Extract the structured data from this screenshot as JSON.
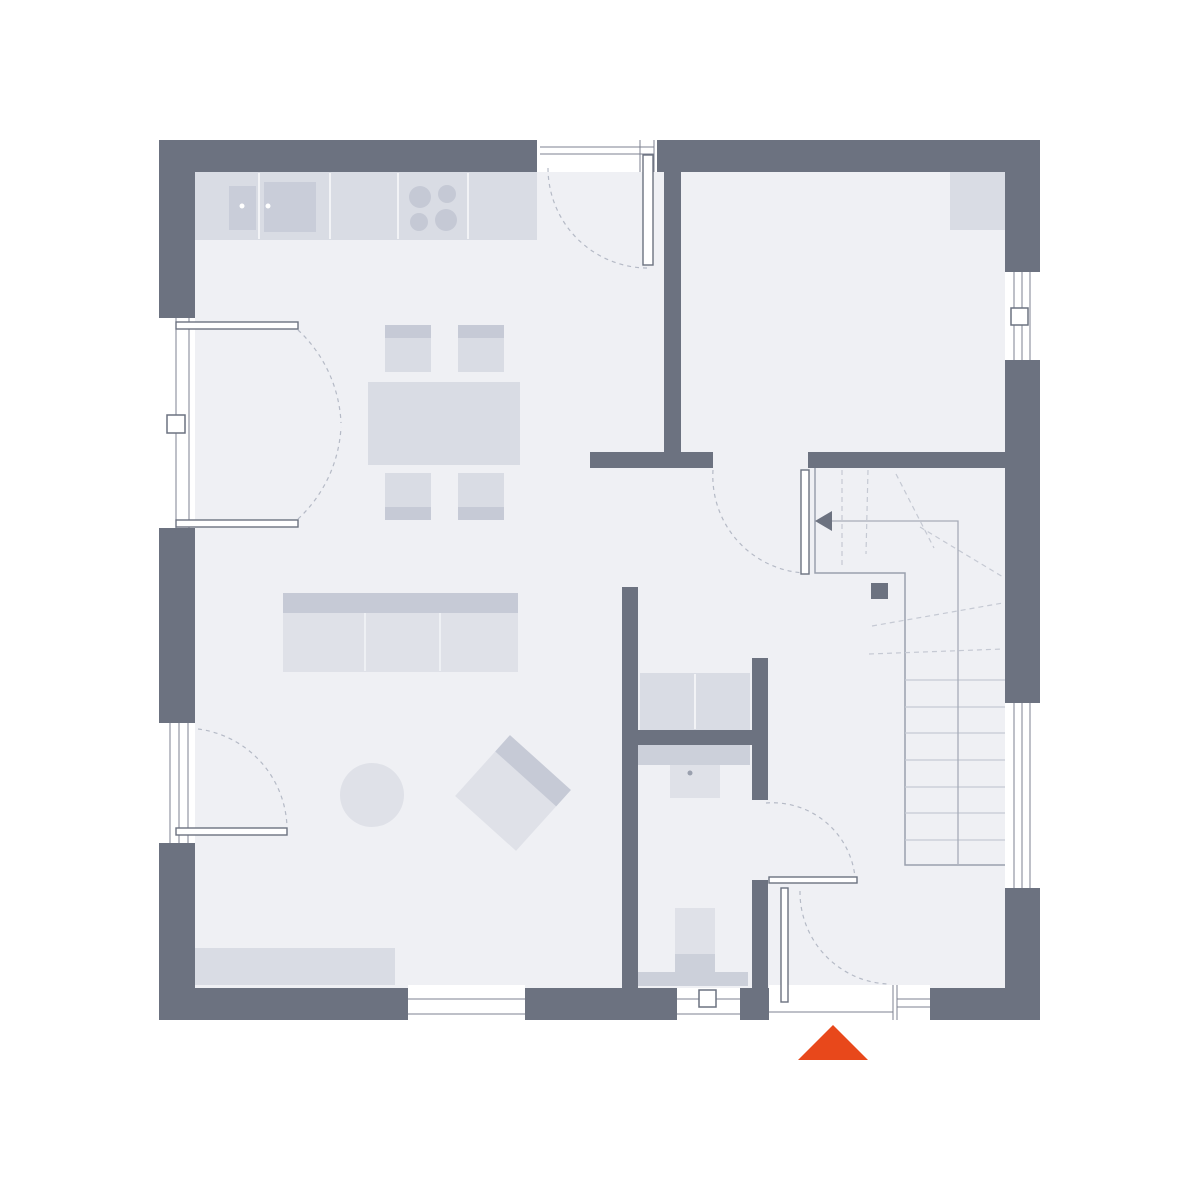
{
  "meta": {
    "kind": "architectural-floor-plan",
    "canvas": {
      "w": 1200,
      "h": 1200
    },
    "background": "#ffffff"
  },
  "palette": {
    "wall": "#6c7280",
    "floor": "#eff0f4",
    "white": "#ffffff",
    "furn_mid": "#d9dce4",
    "furn_light": "#dfe1e8",
    "furn_dark": "#c6cad6",
    "furn_deep": "#ccd0da",
    "sink": "#c9cdd9",
    "burner": "#c5c9d5",
    "frame_line": "#7d8290",
    "tread_line": "#c5c9d3",
    "dash_line": "#b5bac6",
    "walk_line": "#a6abb8",
    "divider_line": "#f2f3f6",
    "sofa_divider": "#eef0f4",
    "stair_edge": "#9aa0ad",
    "faucet": "#9aa0ae",
    "accent": "#e8481b"
  },
  "floor": {
    "n": "floor-area",
    "r": [
      195,
      172,
      810,
      816
    ],
    "f": "floor"
  },
  "walls": {
    "exterior": [
      {
        "n": "wall-top-left",
        "r": [
          159,
          140,
          378,
          32
        ]
      },
      {
        "n": "wall-top-right",
        "r": [
          657,
          140,
          383,
          32
        ]
      },
      {
        "n": "wall-left-upper",
        "r": [
          159,
          140,
          36,
          178
        ]
      },
      {
        "n": "wall-left-middle",
        "r": [
          159,
          528,
          36,
          195
        ]
      },
      {
        "n": "wall-left-lower",
        "r": [
          159,
          843,
          36,
          177
        ]
      },
      {
        "n": "wall-right-upper",
        "r": [
          1005,
          140,
          35,
          132
        ]
      },
      {
        "n": "wall-right-middle",
        "r": [
          1005,
          360,
          35,
          343
        ]
      },
      {
        "n": "wall-right-lower",
        "r": [
          1005,
          888,
          35,
          132
        ]
      },
      {
        "n": "wall-bottom-1",
        "r": [
          159,
          988,
          249,
          32
        ]
      },
      {
        "n": "wall-bottom-2",
        "r": [
          525,
          988,
          152,
          32
        ]
      },
      {
        "n": "wall-bottom-3",
        "r": [
          740,
          988,
          29,
          32
        ]
      },
      {
        "n": "wall-bottom-4",
        "r": [
          930,
          988,
          110,
          32
        ]
      }
    ],
    "interior": [
      {
        "n": "wall-kitchen-room-divider",
        "r": [
          664,
          172,
          17,
          280
        ]
      },
      {
        "n": "wall-stub-dining",
        "r": [
          590,
          452,
          123,
          16
        ]
      },
      {
        "n": "wall-stairs-top",
        "r": [
          808,
          452,
          197,
          16
        ]
      },
      {
        "n": "wall-living-hall",
        "r": [
          622,
          587,
          16,
          401
        ]
      },
      {
        "n": "wall-utility-wc",
        "r": [
          622,
          730,
          146,
          15
        ]
      },
      {
        "n": "wall-wc-right-upper",
        "r": [
          752,
          658,
          16,
          142
        ]
      },
      {
        "n": "wall-wc-right-lower",
        "r": [
          752,
          880,
          16,
          108
        ]
      }
    ]
  },
  "windows": [
    {
      "n": "top-entry-door-opening",
      "box": [
        537,
        136,
        120,
        36
      ],
      "segments": [
        [
          540,
          147,
          654,
          147
        ],
        [
          540,
          154,
          654,
          154
        ],
        [
          640,
          140,
          640,
          172
        ],
        [
          654,
          140,
          654,
          172
        ]
      ]
    },
    {
      "n": "french-door-opening",
      "box": [
        160,
        318,
        35,
        210
      ],
      "segments": [
        [
          176,
          318,
          176,
          528
        ],
        [
          189,
          318,
          189,
          528
        ]
      ],
      "symbol": [
        167,
        415,
        18,
        18
      ]
    },
    {
      "n": "window-left-lower",
      "box": [
        160,
        723,
        35,
        120
      ],
      "segments": [
        [
          170,
          723,
          170,
          843
        ],
        [
          179,
          723,
          179,
          843
        ],
        [
          188,
          723,
          188,
          843
        ]
      ]
    },
    {
      "n": "window-right-upper",
      "box": [
        1007,
        272,
        34,
        88
      ],
      "segments": [
        [
          1014,
          272,
          1014,
          360
        ],
        [
          1022,
          272,
          1022,
          360
        ],
        [
          1030,
          272,
          1030,
          360
        ]
      ],
      "symbol": [
        1011,
        308,
        17,
        17
      ]
    },
    {
      "n": "window-right-lower",
      "box": [
        1007,
        703,
        34,
        185
      ],
      "segments": [
        [
          1014,
          703,
          1014,
          888
        ],
        [
          1022,
          703,
          1022,
          888
        ],
        [
          1030,
          703,
          1030,
          888
        ]
      ]
    },
    {
      "n": "window-wc",
      "box": [
        677,
        988,
        63,
        33
      ],
      "segments": [
        [
          677,
          999,
          740,
          999
        ],
        [
          677,
          1014,
          740,
          1014
        ]
      ],
      "symbol": [
        699,
        990,
        17,
        17
      ]
    },
    {
      "n": "terrace-door-opening",
      "box": [
        408,
        985,
        117,
        35
      ],
      "segments": [
        [
          408,
          999,
          525,
          999
        ],
        [
          408,
          1014,
          525,
          1014
        ]
      ]
    },
    {
      "n": "entrance-door-opening",
      "box": [
        769,
        985,
        161,
        35
      ],
      "segments": [
        [
          769,
          1012,
          893,
          1012
        ],
        [
          893,
          985,
          893,
          1020
        ],
        [
          897,
          985,
          897,
          1020
        ],
        [
          897,
          999,
          930,
          999
        ],
        [
          897,
          1007,
          930,
          1007
        ]
      ]
    }
  ],
  "doors": {
    "leaves": [
      {
        "n": "top-entry-door-leaf",
        "r": [
          643,
          155,
          10,
          110
        ]
      },
      {
        "n": "french-door-leaf-top",
        "r": [
          176,
          322,
          122,
          7
        ]
      },
      {
        "n": "french-door-leaf-bottom",
        "r": [
          176,
          520,
          122,
          7
        ]
      },
      {
        "n": "left-window-leaf",
        "r": [
          176,
          828,
          111,
          7
        ]
      },
      {
        "n": "hall-room-door-leaf",
        "r": [
          801,
          470,
          8,
          104
        ]
      },
      {
        "n": "wc-door-leaf",
        "r": [
          769,
          877,
          88,
          6
        ]
      },
      {
        "n": "entrance-door-leaf",
        "r": [
          781,
          888,
          7,
          114
        ]
      }
    ],
    "arcs": [
      {
        "n": "top-entry-door-swing",
        "d": "M 548 168 A 100 100 0 0 0 648 268"
      },
      {
        "n": "french-door-swing-top",
        "d": "M 298 330 A 135 135 0 0 1 341 423"
      },
      {
        "n": "french-door-swing-bottom",
        "d": "M 298 519 A 135 135 0 0 0 341 427"
      },
      {
        "n": "left-window-swing",
        "d": "M 198 729 A 102 102 0 0 1 287 827"
      },
      {
        "n": "hall-room-door-swing",
        "d": "M 713 470 A 97 97 0 0 0 805 573"
      },
      {
        "n": "wc-door-swing",
        "d": "M 766 803 A 83 83 0 0 1 855 877"
      },
      {
        "n": "entrance-door-swing",
        "d": "M 800 891 A 92 92 0 0 0 888 984"
      }
    ]
  },
  "furniture": {
    "rects": [
      {
        "n": "kitchen-counter",
        "r": [
          195,
          172,
          342,
          68
        ],
        "f": "furn_mid"
      },
      {
        "n": "kitchen-sink-basin-left",
        "r": [
          229,
          186,
          27,
          44
        ],
        "f": "sink"
      },
      {
        "n": "kitchen-sink-basin-right",
        "r": [
          264,
          182,
          52,
          50
        ],
        "f": "sink"
      },
      {
        "n": "dining-table",
        "r": [
          368,
          382,
          152,
          83
        ],
        "f": "furn_mid"
      },
      {
        "n": "dining-chair-top-left",
        "r": [
          385,
          325,
          46,
          47
        ],
        "f": "furn_mid"
      },
      {
        "n": "dining-chair-top-right",
        "r": [
          458,
          325,
          46,
          47
        ],
        "f": "furn_mid"
      },
      {
        "n": "dining-chair-bottom-left",
        "r": [
          385,
          473,
          46,
          47
        ],
        "f": "furn_mid"
      },
      {
        "n": "dining-chair-bottom-right",
        "r": [
          458,
          473,
          46,
          47
        ],
        "f": "furn_mid"
      },
      {
        "n": "dining-chair-back-top-left",
        "r": [
          385,
          325,
          46,
          13
        ],
        "f": "furn_dark"
      },
      {
        "n": "dining-chair-back-top-right",
        "r": [
          458,
          325,
          46,
          13
        ],
        "f": "furn_dark"
      },
      {
        "n": "dining-chair-back-bottom-left",
        "r": [
          385,
          507,
          46,
          13
        ],
        "f": "furn_dark"
      },
      {
        "n": "dining-chair-back-bottom-right",
        "r": [
          458,
          507,
          46,
          13
        ],
        "f": "furn_dark"
      },
      {
        "n": "sofa-backrest",
        "r": [
          283,
          593,
          235,
          20
        ],
        "f": "furn_dark"
      },
      {
        "n": "sofa-seat",
        "r": [
          283,
          613,
          235,
          59
        ],
        "f": "furn_light"
      },
      {
        "n": "armchair-body",
        "r": [
          472,
          752,
          82,
          82
        ],
        "f": "furn_light",
        "t": "rotate(42 513 793)"
      },
      {
        "n": "armchair-backrest",
        "r": [
          472,
          752,
          82,
          22
        ],
        "f": "furn_dark",
        "t": "rotate(42 513 793)"
      },
      {
        "n": "sideboard",
        "r": [
          195,
          948,
          200,
          37
        ],
        "f": "furn_mid"
      },
      {
        "n": "closet-top-right-room",
        "r": [
          950,
          172,
          57,
          58
        ],
        "f": "furn_mid"
      },
      {
        "n": "utility-appliances",
        "r": [
          640,
          673,
          110,
          57
        ],
        "f": "furn_mid"
      },
      {
        "n": "wc-vanity-counter",
        "r": [
          638,
          745,
          112,
          20
        ],
        "f": "furn_deep"
      },
      {
        "n": "wc-washbasin",
        "r": [
          670,
          765,
          50,
          33
        ],
        "f": "furn_light"
      },
      {
        "n": "wc-toilet-bowl",
        "r": [
          675,
          908,
          40,
          46
        ],
        "f": "furn_light"
      },
      {
        "n": "wc-toilet-cistern",
        "r": [
          675,
          954,
          40,
          18
        ],
        "f": "furn_deep"
      },
      {
        "n": "wc-window-sill-band",
        "r": [
          638,
          972,
          110,
          14
        ],
        "f": "furn_deep"
      }
    ],
    "circles": [
      {
        "n": "cooktop-burner-1",
        "c": [
          420,
          197,
          11
        ],
        "f": "burner"
      },
      {
        "n": "cooktop-burner-2",
        "c": [
          447,
          194,
          9
        ],
        "f": "burner"
      },
      {
        "n": "cooktop-burner-3",
        "c": [
          419,
          222,
          9
        ],
        "f": "burner"
      },
      {
        "n": "cooktop-burner-4",
        "c": [
          446,
          220,
          11
        ],
        "f": "burner"
      },
      {
        "n": "sink-drain-left",
        "c": [
          242,
          206,
          2.5
        ],
        "f": "white"
      },
      {
        "n": "sink-drain-right",
        "c": [
          268,
          206,
          2.5
        ],
        "f": "white"
      },
      {
        "n": "round-pouf",
        "c": [
          372,
          795,
          32
        ],
        "f": "furn_light"
      },
      {
        "n": "wc-basin-faucet",
        "c": [
          690,
          773,
          2.5
        ],
        "f": "faucet"
      }
    ],
    "lines": [
      {
        "n": "counter-divider-1",
        "s": [
          259,
          173,
          259,
          239
        ],
        "f": "divider_line",
        "w": 2
      },
      {
        "n": "counter-divider-2",
        "s": [
          330,
          173,
          330,
          239
        ],
        "f": "divider_line",
        "w": 2
      },
      {
        "n": "counter-divider-3",
        "s": [
          398,
          173,
          398,
          239
        ],
        "f": "divider_line",
        "w": 2
      },
      {
        "n": "counter-divider-4",
        "s": [
          468,
          173,
          468,
          239
        ],
        "f": "divider_line",
        "w": 2
      },
      {
        "n": "sofa-cushion-divider-1",
        "s": [
          365,
          613,
          365,
          671
        ],
        "f": "sofa_divider",
        "w": 2
      },
      {
        "n": "sofa-cushion-divider-2",
        "s": [
          440,
          613,
          440,
          671
        ],
        "f": "sofa_divider",
        "w": 2
      },
      {
        "n": "appliance-divider",
        "s": [
          695,
          674,
          695,
          729
        ],
        "f": "divider_line",
        "w": 2
      }
    ]
  },
  "stairs": {
    "outline": {
      "n": "stair-outline",
      "d": "M 815 468 L 815 573 L 905 573 L 905 865 L 1005 865"
    },
    "treads": [
      {
        "n": "stair-tread",
        "s": [
          905,
          680,
          1005,
          680
        ]
      },
      {
        "n": "stair-tread",
        "s": [
          905,
          707,
          1005,
          707
        ]
      },
      {
        "n": "stair-tread",
        "s": [
          905,
          733,
          1005,
          733
        ]
      },
      {
        "n": "stair-tread",
        "s": [
          905,
          760,
          1005,
          760
        ]
      },
      {
        "n": "stair-tread",
        "s": [
          905,
          787,
          1005,
          787
        ]
      },
      {
        "n": "stair-tread",
        "s": [
          905,
          813,
          1005,
          813
        ]
      },
      {
        "n": "stair-tread",
        "s": [
          905,
          840,
          1005,
          840
        ]
      }
    ],
    "winders": [
      {
        "n": "stair-winder",
        "s": [
          842,
          470,
          842,
          566
        ]
      },
      {
        "n": "stair-winder",
        "s": [
          868,
          470,
          866,
          554
        ]
      },
      {
        "n": "stair-winder",
        "s": [
          896,
          474,
          934,
          548
        ]
      },
      {
        "n": "stair-winder",
        "s": [
          920,
          527,
          1003,
          577
        ]
      },
      {
        "n": "stair-winder",
        "s": [
          872,
          626,
          1003,
          603
        ]
      },
      {
        "n": "stair-winder",
        "s": [
          869,
          654,
          1003,
          649
        ]
      }
    ],
    "walk_line": {
      "n": "stair-walk-line",
      "d": "M 958 864 L 958 521 L 824 521"
    },
    "arrow": {
      "n": "stair-direction-arrow",
      "points": "832,511 815,521 832,531"
    },
    "post": {
      "n": "stair-newel-post",
      "r": [
        871,
        583,
        17,
        16
      ]
    }
  },
  "entrance_marker": {
    "n": "entrance-marker-triangle",
    "points": "798,1060 868,1060 833,1025",
    "f": "accent"
  }
}
